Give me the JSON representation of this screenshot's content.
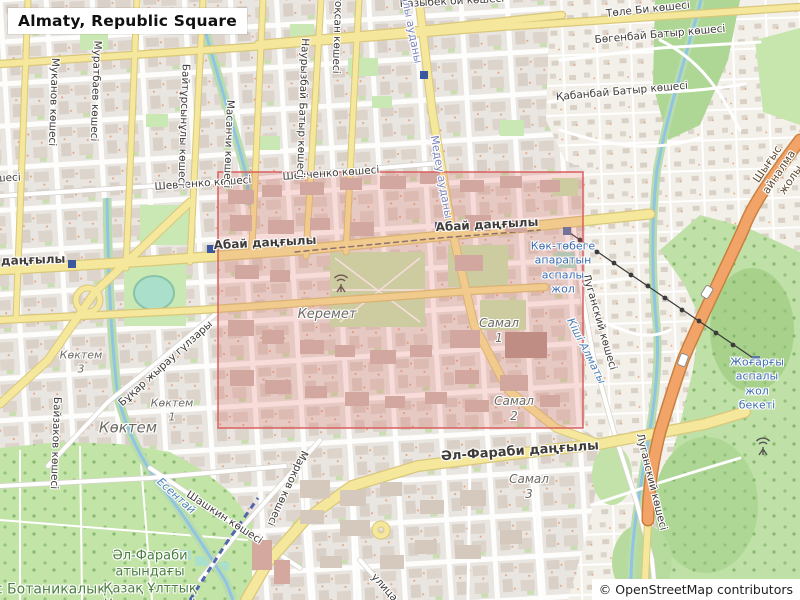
{
  "title": "Almaty, Republic Square",
  "attribution": "© OpenStreetMap contributors",
  "colors": {
    "land": "#f2efe9",
    "city_block": "#e9e5e0",
    "building": "#d9d0c7",
    "road_white": "#ffffff",
    "road_yellow": "#f5e79b",
    "road_yellow_casing": "#d9c87c",
    "road_trunk": "#f2a368",
    "road_trunk_casing": "#c9803f",
    "park": "#c9e8b3",
    "forest": "#aed694",
    "pitch": "#aae0cb",
    "water": "#8fc4e2",
    "water_fringe": "#b9dcae",
    "metro_blue": "#3a57a0",
    "cable_line": "#3b3b3b",
    "highlight_fill": "rgba(224,92,87,0.20)",
    "highlight_border": "#d95f5f"
  },
  "labels": {
    "tole_bi": "Төле Би көшесі",
    "bogenbay": "Бөгенбай Батыр көшесі",
    "kabanbay": "Қабанбай Батыр көшесі",
    "kazybek": "Қазыбек би көшесі",
    "shevchenko_w": "Шевченко көшесі",
    "shevchenko_e": "Шевченко көшесі",
    "abai_w": "Абай даңғылы",
    "abai_c": "Абай даңғылы",
    "abai_e": "Абай даңғылы",
    "al_farabi": "Әл-Фараби даңғылы",
    "mukanov": "Муканов көшесі",
    "muratbaev": "Муратбаев көшесі",
    "baitursynuly": "Байтұрсынұлы көшесі",
    "masanchi": "Масанчи көшесі",
    "nauryzbai": "Наурызбай Батыр көшесі",
    "zheltoksan": "Желтоқсан көшесі",
    "koshesi_cut": "көшесі",
    "baizakov": "Байзаков көшесі",
    "markov": "Марков көшесі",
    "shashkin": "Шашкин көшесі",
    "luganskiy_n": "Луганский көшесі",
    "luganskiy_s": "Луганский көшесі",
    "bukhar_zhyrau": "Бұқар жырау гүлзары",
    "ulitsa": "улица",
    "ring_road": "Шығыс айналма жолы",
    "district_almaly": "Алмалы ауданы",
    "district_medeu": "Медеу ауданы",
    "river_esentai": "Есентай",
    "river_kishi_almaty": "Кіші Алматы",
    "koktem": "Көктем",
    "koktem1": "Көктем\n1",
    "koktem3": "Көктем\n3",
    "keremet": "Керемет",
    "samal1": "Самал\n1",
    "samal2": "Самал\n2",
    "samal3": "Самал\n3",
    "botanical": "ас Ботаникалық",
    "university": "Әл-Фараби\nатындағы\nҚазақ Ұлттық\nУниверситеті",
    "cable_car": "Көк-төбеге\nапаратын\nаспалы\nжол",
    "cable_station": "Жоғарғы\nаспалы\nжол бекеті"
  }
}
